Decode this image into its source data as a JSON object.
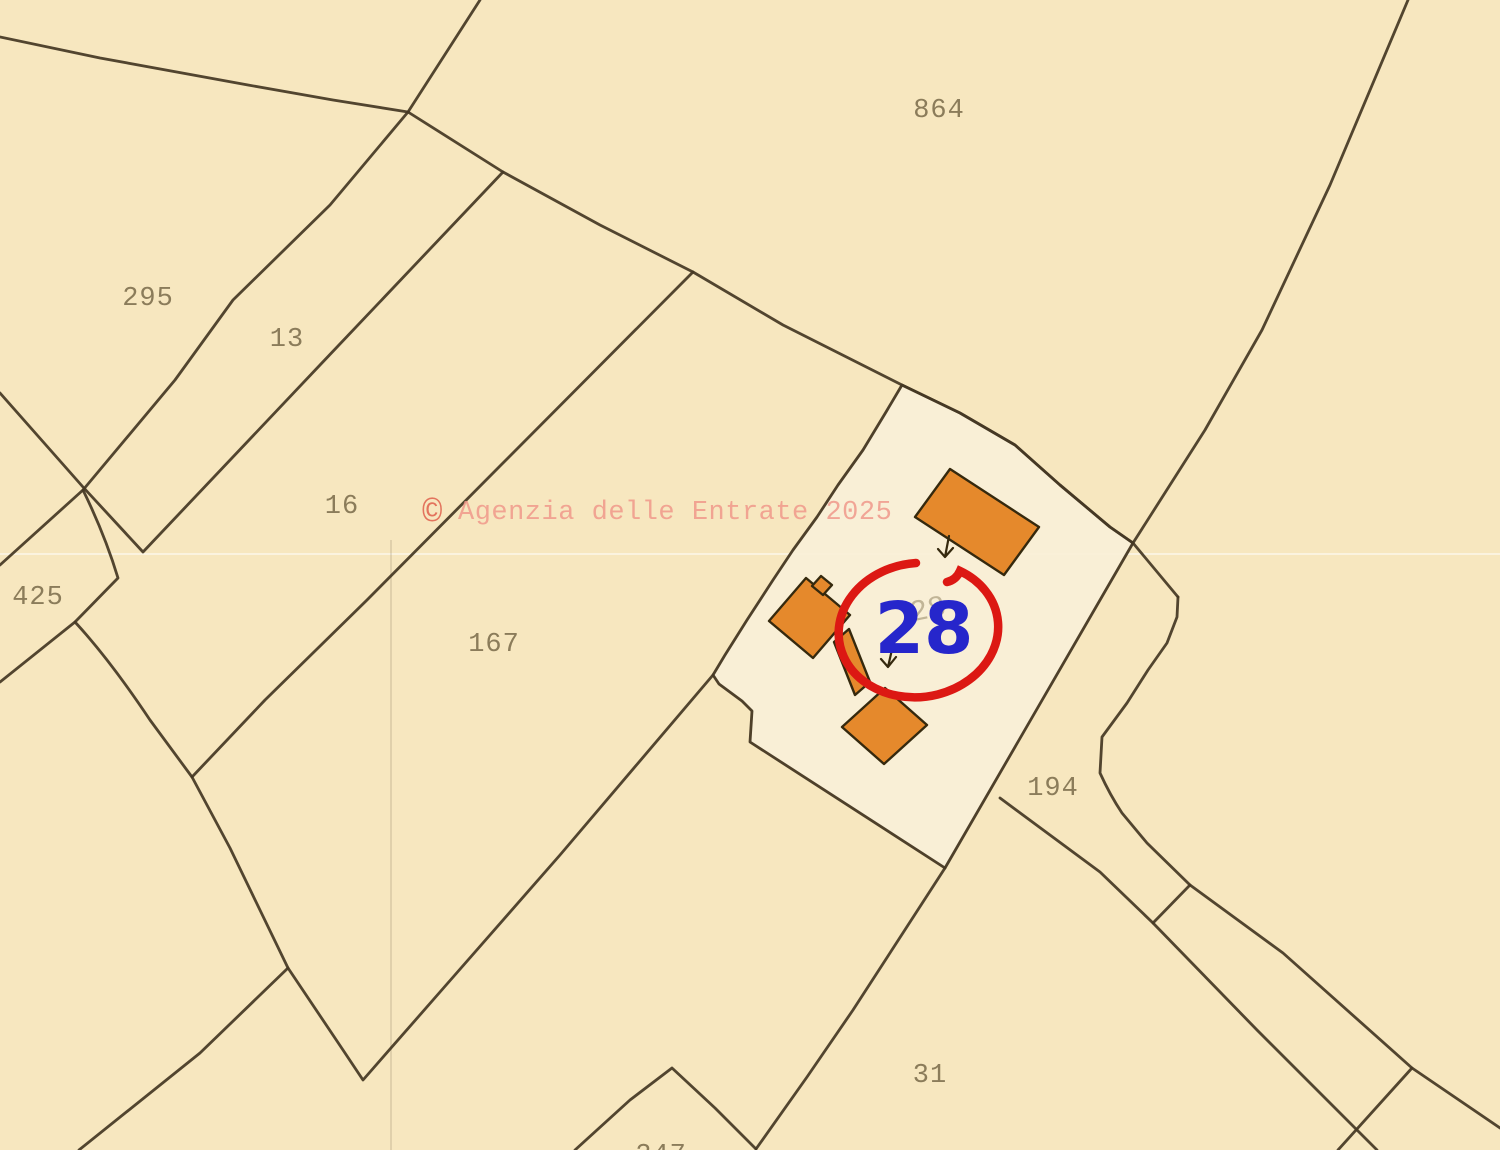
{
  "map": {
    "background_color": "#f7e7bf",
    "highlight_parcel_fill": "#faf0d8",
    "boundary_color": "#453823",
    "building_fill": "#e5892c",
    "building_stroke": "#35290e",
    "label_color": "#8b7c5a",
    "watermark": {
      "symbol": "©",
      "text": "Agenzia delle Entrate 2025",
      "color": "#f0998b"
    },
    "highlight": {
      "value": "28",
      "shadow_value": "28",
      "number_color": "#2626cb",
      "circle_color": "#dc1813"
    },
    "parcels": [
      {
        "label": "864"
      },
      {
        "label": "295"
      },
      {
        "label": "13"
      },
      {
        "label": "16"
      },
      {
        "label": "425"
      },
      {
        "label": "167"
      },
      {
        "label": "194"
      },
      {
        "label": "31"
      },
      {
        "label": "247"
      }
    ]
  }
}
